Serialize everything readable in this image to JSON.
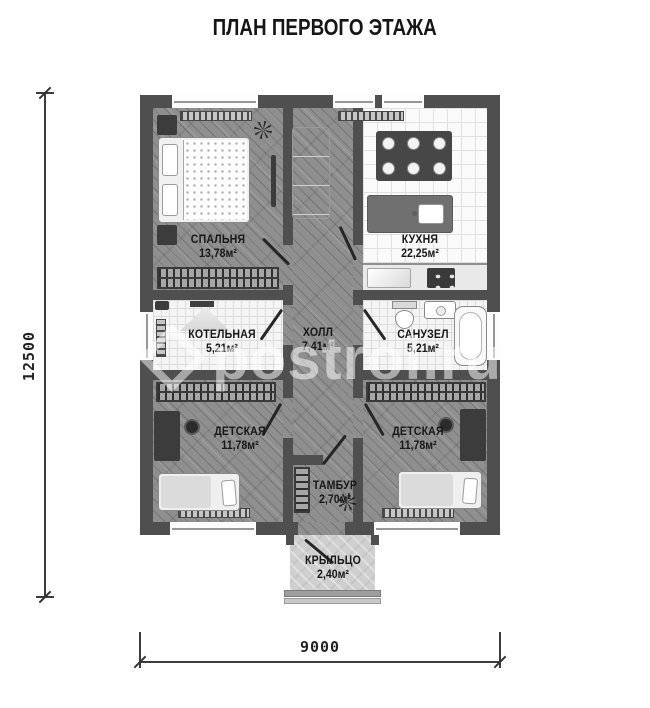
{
  "title": "ПЛАН ПЕРВОГО ЭТАЖА",
  "watermark": {
    "text": "postroi.ru"
  },
  "dimensions": {
    "vertical": "12500",
    "horizontal": "9000"
  },
  "rooms": [
    {
      "id": "bedroom",
      "name": "СПАЛЬНЯ",
      "area": "13,78м²"
    },
    {
      "id": "kitchen",
      "name": "КУХНЯ",
      "area": "22,25м²"
    },
    {
      "id": "boiler-room",
      "name": "КОТЕЛЬНАЯ",
      "area": "5,21м²"
    },
    {
      "id": "hall",
      "name": "ХОЛЛ",
      "area": "7,41м²"
    },
    {
      "id": "bathroom",
      "name": "САНУЗЕЛ",
      "area": "5,21м²"
    },
    {
      "id": "nursery-left",
      "name": "ДЕТСКАЯ",
      "area": "11,78м²"
    },
    {
      "id": "nursery-right",
      "name": "ДЕТСКАЯ",
      "area": "11,78м²"
    },
    {
      "id": "vestibule",
      "name": "ТАМБУР",
      "area": "2,70м²"
    },
    {
      "id": "porch",
      "name": "КРЫЛЬЦО",
      "area": "2,40м²"
    }
  ],
  "furniture_icons": [
    "double-bed",
    "nightstand",
    "tv-panel",
    "plant",
    "wardrobe-hangers",
    "sofa",
    "dining-table",
    "plates",
    "kitchen-island",
    "island-sink",
    "kitchen-counter",
    "counter-sink",
    "stove",
    "boiler-hood",
    "toilet",
    "washbasin",
    "bathtub",
    "desk",
    "chair",
    "single-bed",
    "radiator",
    "window",
    "door-leaf",
    "porch-steps"
  ],
  "colors": {
    "wall": "#4f4f4f",
    "wood_floor": "#8f8f8f",
    "tile_floor": "#f4f4f4",
    "porch": "#cfcfcf",
    "label_text": "#181818",
    "dimension_text": "#222222",
    "watermark": "rgba(255,255,255,0.52)"
  }
}
